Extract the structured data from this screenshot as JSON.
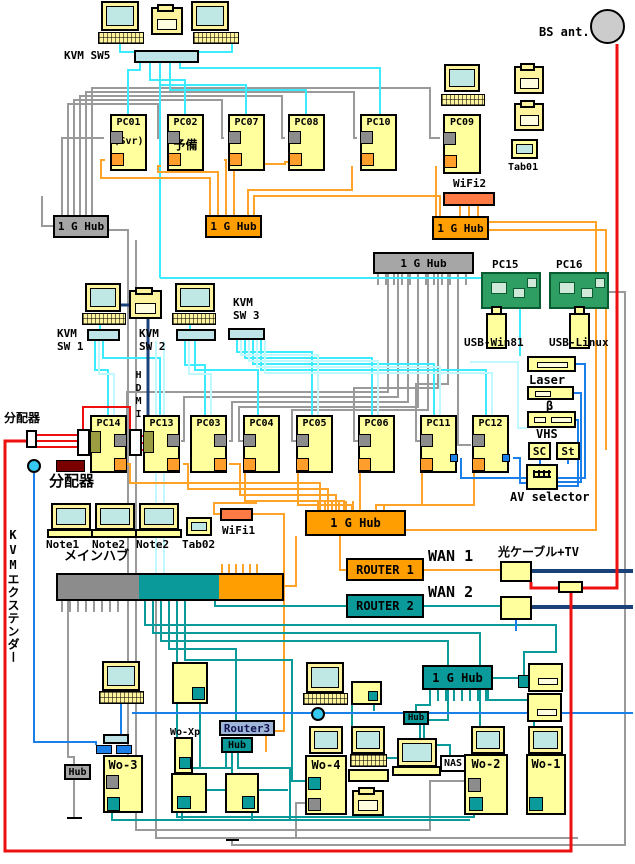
{
  "colors": {
    "device_yellow": "#FFFF9E",
    "screen_cyan": "#BFE8E4",
    "wire_cyan": "#3DEBFF",
    "wire_pale_cyan": "#BFF8FF",
    "wire_grey": "#9A9A9A",
    "wire_orange": "#FFA228",
    "wire_teal": "#0A9A9A",
    "wire_blue": "#1A7FE8",
    "wire_navy": "#1B4179",
    "wire_red": "#EE0F0F",
    "hub_grey": "#A6A6A6",
    "hub_orange": "#FF9E00",
    "hub_teal": "#0A9A9A",
    "wifi_orange": "#FF7A45",
    "router3_fill": "#9FB6D9",
    "splitter_darkred": "#7A0000"
  },
  "top": {
    "kvm_sw5_label": "KVM SW5",
    "bs_antenna_label": "BS ant.",
    "pc01": {
      "name": "PC01",
      "sub": "(Svr)"
    },
    "pc02": {
      "name": "PC02",
      "sub": "予備"
    },
    "pc07": "PC07",
    "pc08": "PC08",
    "pc10": "PC10",
    "pc09": "PC09",
    "tab01": "Tab01",
    "wifi2": "WiFi2",
    "hub_grey": "1 G Hub",
    "hub_orange_mid": "1 G Hub",
    "hub_orange_right": "1 G Hub"
  },
  "middle": {
    "hub_grey": "1 G Hub",
    "pc15": "PC15",
    "pc16": "PC16",
    "usb_win": "USB-Win81",
    "usb_linux": "USB-Linux",
    "kvm_sw1": "KVM\nSW 1",
    "kvm_sw2": "KVM\nSW 2",
    "kvm_sw3": "KVM\nSW 3",
    "hdmi": "HDMI",
    "pc14": "PC14",
    "pc13": "PC13",
    "pc03": "PC03",
    "pc04": "PC04",
    "pc05": "PC05",
    "pc06": "PC06",
    "pc11": "PC11",
    "pc12": "PC12",
    "splitter_label_1": "分配器",
    "splitter_label_2": "分配器",
    "laser": "Laser",
    "beta": "β",
    "vhs": "VHS",
    "sc": "SC",
    "st": "St",
    "av_selector": "AV selector",
    "note1": "Note1",
    "note2a": "Note2",
    "note2b": "Note2",
    "tab02": "Tab02",
    "wifi1": "WiFi1",
    "main_hub_label": "メインハブ",
    "hub_orange": "1 G Hub"
  },
  "wan": {
    "router1": "ROUTER 1",
    "wan1": "WAN 1",
    "fiber_tv": "光ケーブル+TV",
    "router2": "ROUTER 2",
    "wan2": "WAN 2"
  },
  "bottom": {
    "kvm_extender": "KVMエクステンダー",
    "wo3": "Wo-3",
    "wo4": "Wo-4",
    "wo2": "Wo-2",
    "wo1": "Wo-1",
    "wo_xp": "Wo-Xp",
    "hub_grey": "Hub",
    "router3": "Router3",
    "hub_teal_small": "Hub",
    "hub_teal_mid": "Hub",
    "hub_1g": "1 G Hub",
    "nas": "NAS"
  }
}
